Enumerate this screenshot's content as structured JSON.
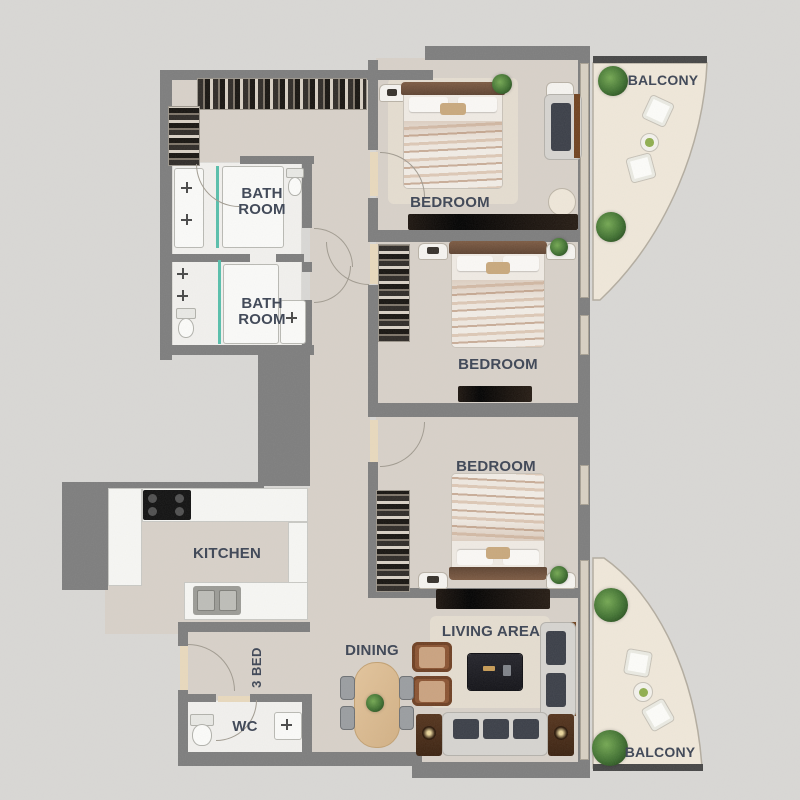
{
  "plan": {
    "unit_type_label": "3 BED",
    "rooms": [
      {
        "id": "bathroom-1",
        "label": "BATH ROOM"
      },
      {
        "id": "bathroom-2",
        "label": "BATH ROOM"
      },
      {
        "id": "bedroom-1",
        "label": "BEDROOM"
      },
      {
        "id": "bedroom-2",
        "label": "BEDROOM"
      },
      {
        "id": "bedroom-3",
        "label": "BEDROOM"
      },
      {
        "id": "kitchen",
        "label": "KITCHEN"
      },
      {
        "id": "dining",
        "label": "DINING"
      },
      {
        "id": "living-area",
        "label": "LIVING AREA"
      },
      {
        "id": "wc",
        "label": "WC"
      },
      {
        "id": "balcony-top",
        "label": "BALCONY"
      },
      {
        "id": "balcony-bottom",
        "label": "BALCONY"
      }
    ],
    "colors": {
      "background": "#d9d8d5",
      "wall": "#7d7d7d",
      "wall_dark": "#454545",
      "floor": "#d8d1c9",
      "floor_white": "#f2f1ee",
      "balcony_floor": "#f0e8da",
      "label_text": "#3c4454",
      "glass": "#57bfab",
      "plant_green": "#3f7030",
      "wood_table": "#d9b88c"
    }
  }
}
